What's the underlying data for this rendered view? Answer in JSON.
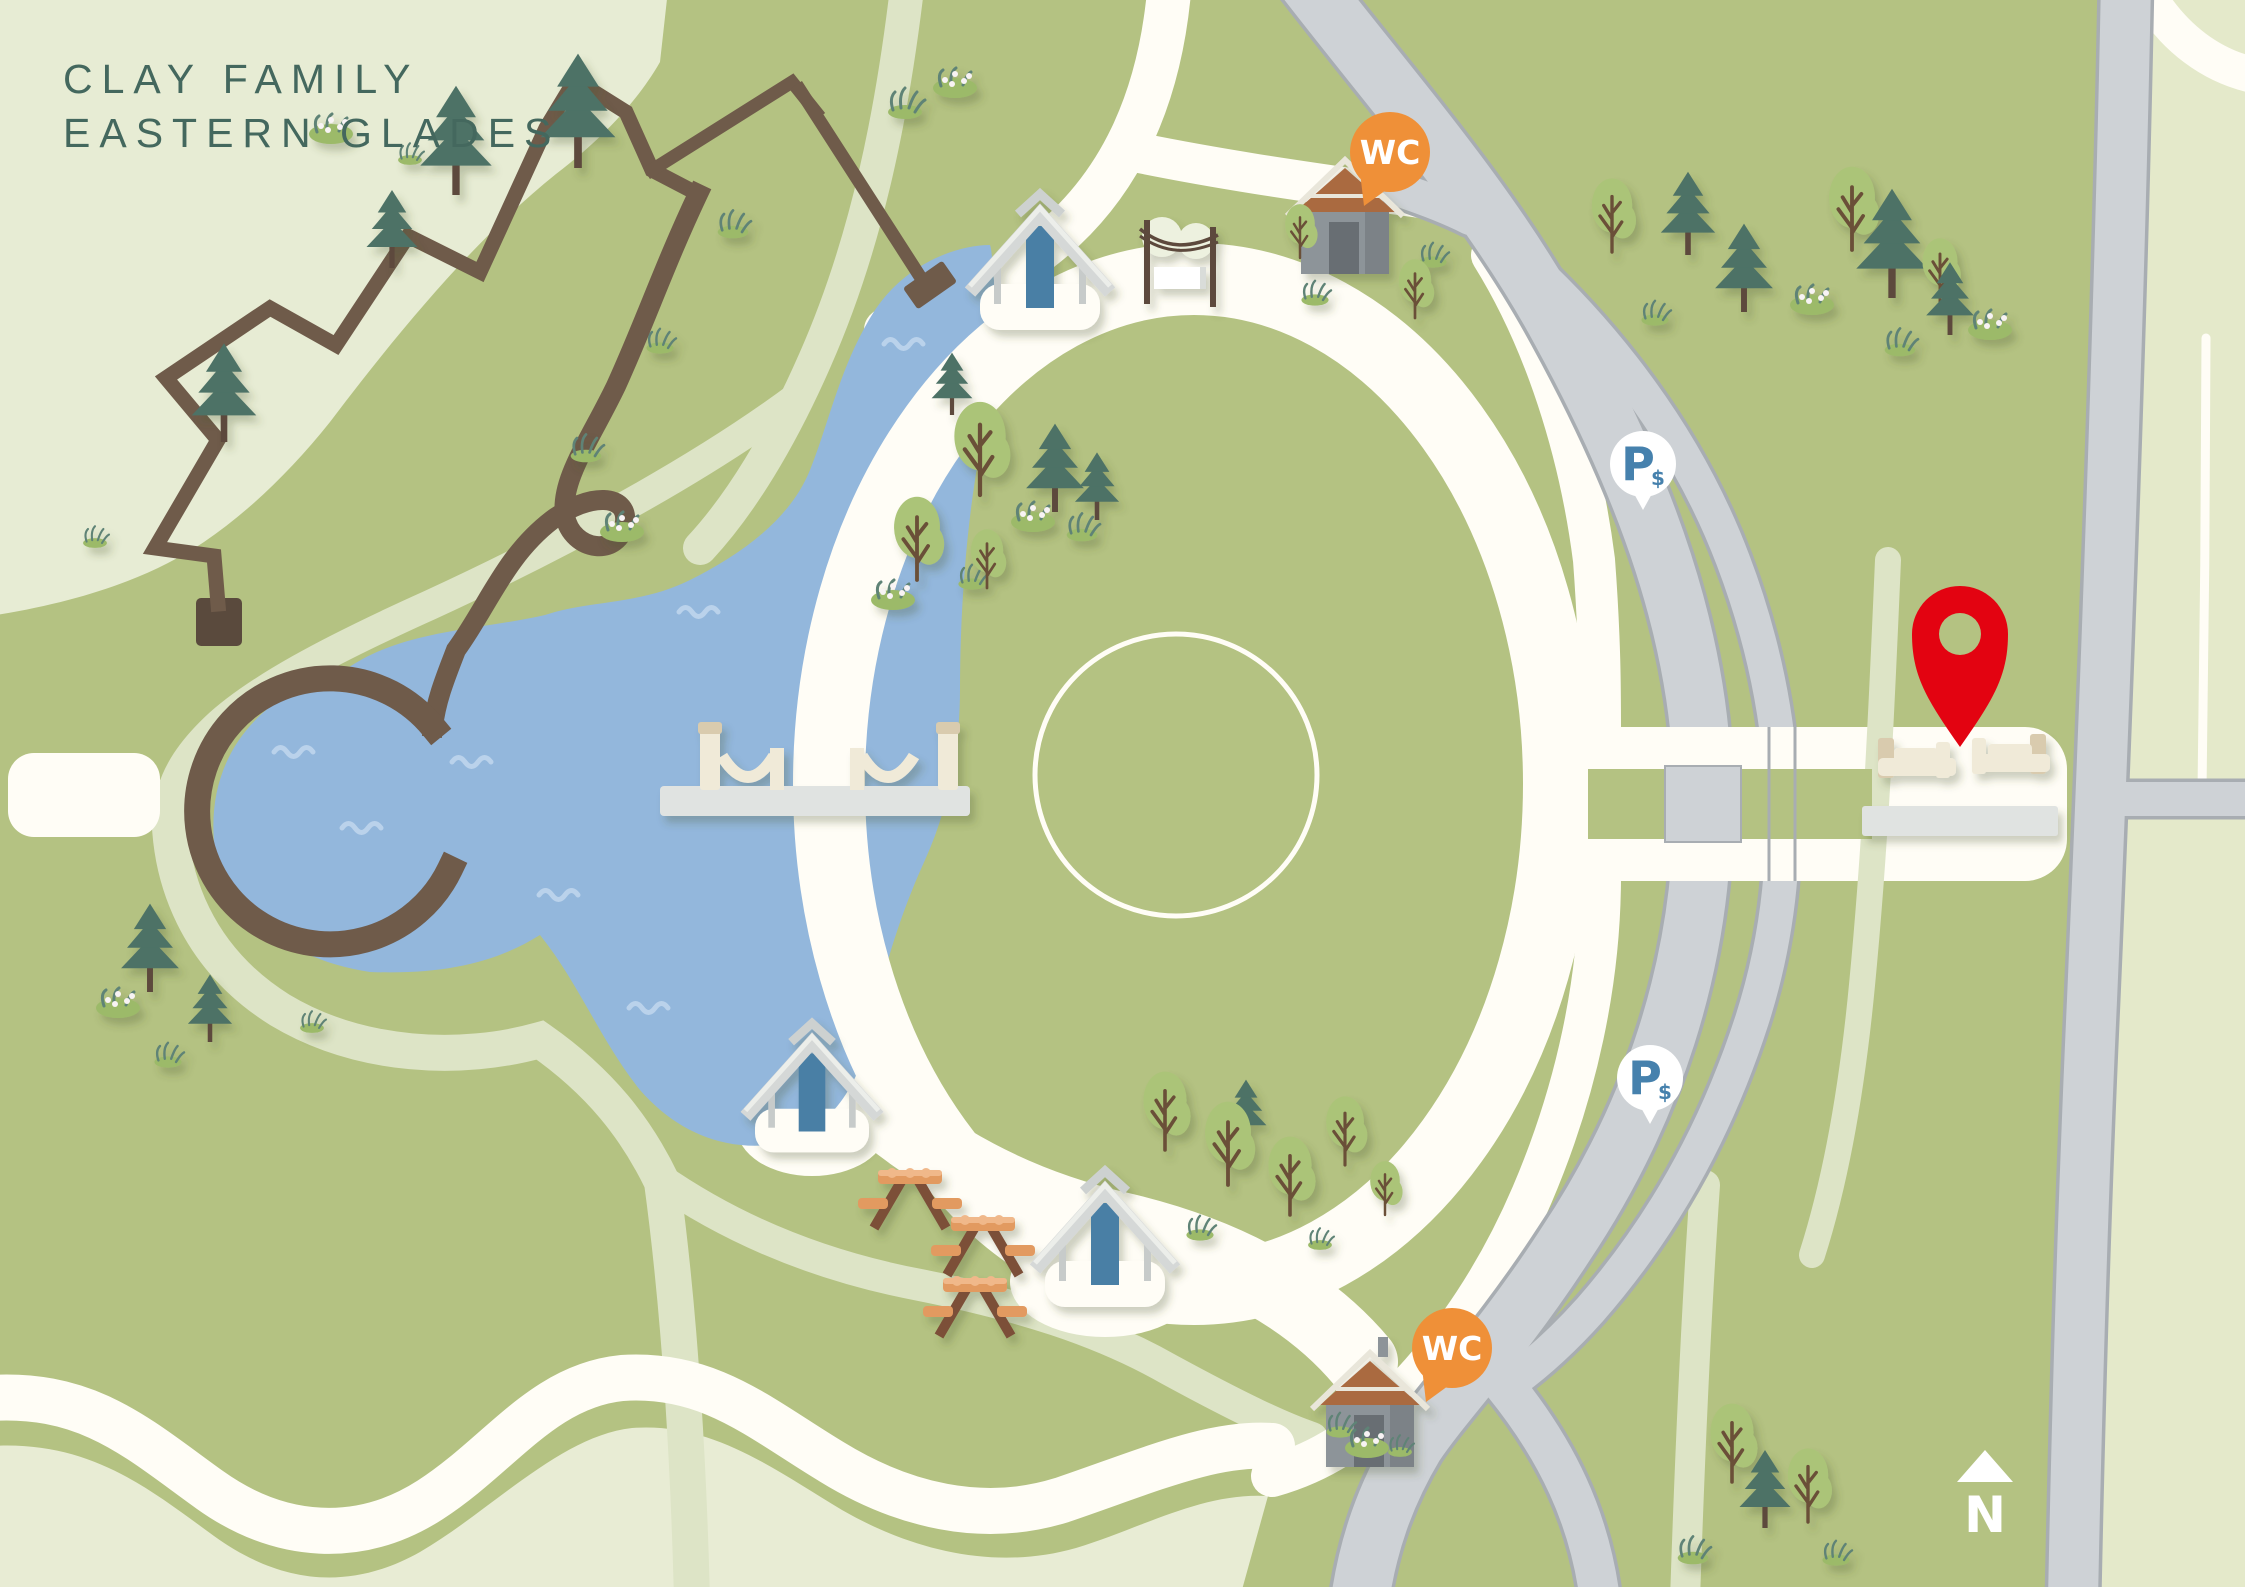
{
  "title": {
    "line1": "CLAY FAMILY",
    "line2": "EASTERN GLADES"
  },
  "compass": {
    "label": "N"
  },
  "markers": {
    "restroom_label": "WC",
    "parking_label": "P",
    "parking_symbol": "$",
    "restrooms": [
      {
        "x": 1390,
        "y": 152
      },
      {
        "x": 1452,
        "y": 1348
      }
    ],
    "paid_parking": [
      {
        "x": 1643,
        "y": 464
      },
      {
        "x": 1650,
        "y": 1078
      }
    ],
    "destination_pin": {
      "x": 1960,
      "y": 634
    },
    "north": {
      "x": 1985,
      "y": 1482
    }
  },
  "colors": {
    "bg": "#b4c282",
    "wedge": "#e7ecd4",
    "cream": "#e8ecd4",
    "sage": "#dde4c6",
    "white": "#fffdf6",
    "faint": "#f3f5ea",
    "east_pale": "#e4e9ca",
    "lake": "#93b7dc",
    "wave": "#bad2eb",
    "road": "#ced2d6",
    "road_edge": "#a8adb2",
    "brown": "#6f5b4a",
    "trail_dark": "#5a4a3d",
    "title": "#44685e",
    "wc_orange": "#ef9038",
    "p_blue": "#4681ad",
    "pin_red": "#e30311",
    "pine": "#4d7266",
    "trunk": "#5d4a3c",
    "tree": "#abc478",
    "branch": "#6b4f38",
    "grass_light": "#9cba69",
    "grass_dark": "#5f8376",
    "flower_dot": "#f8f3f4",
    "picnic_orange": "#e29a60",
    "picnic_light": "#f0b88a",
    "picnic_leg": "#7c4f38",
    "shelter_gray": "#d5d8d7",
    "shelter_light": "#eceeea",
    "shelter_blue": "#4a7fa5",
    "hut_body": "#8d9499",
    "hut_dark": "#7b8287",
    "hut_door": "#676e73",
    "hut_roof": "#aa6a41",
    "hut_trim": "#e9e6da",
    "bench_cream": "#f0ead8",
    "bench_tan": "#d9cbae",
    "platform": "#e0e3e1"
  },
  "features": {
    "pines": [
      [
        456,
        195,
        1.05
      ],
      [
        578,
        168,
        1.1
      ],
      [
        392,
        268,
        0.75
      ],
      [
        224,
        442,
        0.95
      ],
      [
        150,
        992,
        0.85
      ],
      [
        210,
        1042,
        0.65
      ],
      [
        1055,
        512,
        0.85
      ],
      [
        1097,
        520,
        0.65
      ],
      [
        952,
        415,
        0.6
      ],
      [
        1688,
        255,
        0.8
      ],
      [
        1744,
        312,
        0.85
      ],
      [
        1892,
        298,
        1.05
      ],
      [
        1950,
        335,
        0.7
      ],
      [
        1246,
        1142,
        0.6
      ],
      [
        1765,
        1528,
        0.75
      ]
    ],
    "trees": [
      [
        980,
        495,
        0.95
      ],
      [
        917,
        580,
        0.85
      ],
      [
        987,
        588,
        0.6
      ],
      [
        1612,
        252,
        0.75
      ],
      [
        1852,
        250,
        0.85
      ],
      [
        1940,
        302,
        0.65
      ],
      [
        1300,
        258,
        0.55
      ],
      [
        1415,
        318,
        0.6
      ],
      [
        1165,
        1150,
        0.8
      ],
      [
        1228,
        1185,
        0.85
      ],
      [
        1290,
        1215,
        0.8
      ],
      [
        1345,
        1165,
        0.7
      ],
      [
        1385,
        1215,
        0.55
      ],
      [
        1732,
        1482,
        0.8
      ],
      [
        1808,
        1522,
        0.75
      ]
    ],
    "grass": [
      [
        905,
        112,
        1
      ],
      [
        733,
        232,
        0.9
      ],
      [
        586,
        456,
        0.9
      ],
      [
        660,
        348,
        0.8
      ],
      [
        1082,
        535,
        0.9
      ],
      [
        972,
        584,
        0.8
      ],
      [
        1433,
        262,
        0.8
      ],
      [
        1655,
        320,
        0.8
      ],
      [
        1900,
        350,
        0.9
      ],
      [
        1315,
        300,
        0.8
      ],
      [
        1693,
        1558,
        0.9
      ],
      [
        1836,
        1560,
        0.8
      ],
      [
        1200,
        1235,
        0.8
      ],
      [
        1320,
        1245,
        0.7
      ],
      [
        168,
        1062,
        0.8
      ],
      [
        312,
        1028,
        0.7
      ],
      [
        410,
        160,
        0.7
      ],
      [
        1340,
        1432,
        0.8
      ],
      [
        1400,
        1452,
        0.7
      ],
      [
        95,
        543,
        0.7
      ]
    ],
    "flower_bushes": [
      [
        955,
        88
      ],
      [
        622,
        532
      ],
      [
        118,
        1008
      ],
      [
        331,
        134
      ],
      [
        893,
        600
      ],
      [
        1033,
        522
      ],
      [
        1812,
        305
      ],
      [
        1990,
        330
      ],
      [
        1367,
        1448
      ]
    ],
    "waves": [
      [
        300,
        752
      ],
      [
        478,
        762
      ],
      [
        368,
        828
      ],
      [
        565,
        895
      ],
      [
        910,
        344
      ],
      [
        705,
        612
      ],
      [
        655,
        1008
      ]
    ],
    "picnic_tables": [
      [
        910,
        1200
      ],
      [
        983,
        1247
      ],
      [
        975,
        1308
      ]
    ],
    "shelters": [
      [
        1040,
        298,
        1
      ],
      [
        812,
        1122,
        0.95
      ],
      [
        1105,
        1275,
        1
      ]
    ],
    "playground": {
      "x": 1180,
      "y": 265
    },
    "restroom_buildings": [
      [
        1345,
        170
      ],
      [
        1370,
        1363
      ]
    ],
    "bridge": {
      "x": 660,
      "y": 786,
      "width": 310
    },
    "bench_plaza": {
      "platform": [
        1862,
        806,
        196,
        30
      ],
      "benches": [
        [
          1878,
          744
        ],
        [
          1972,
          740
        ]
      ]
    }
  }
}
